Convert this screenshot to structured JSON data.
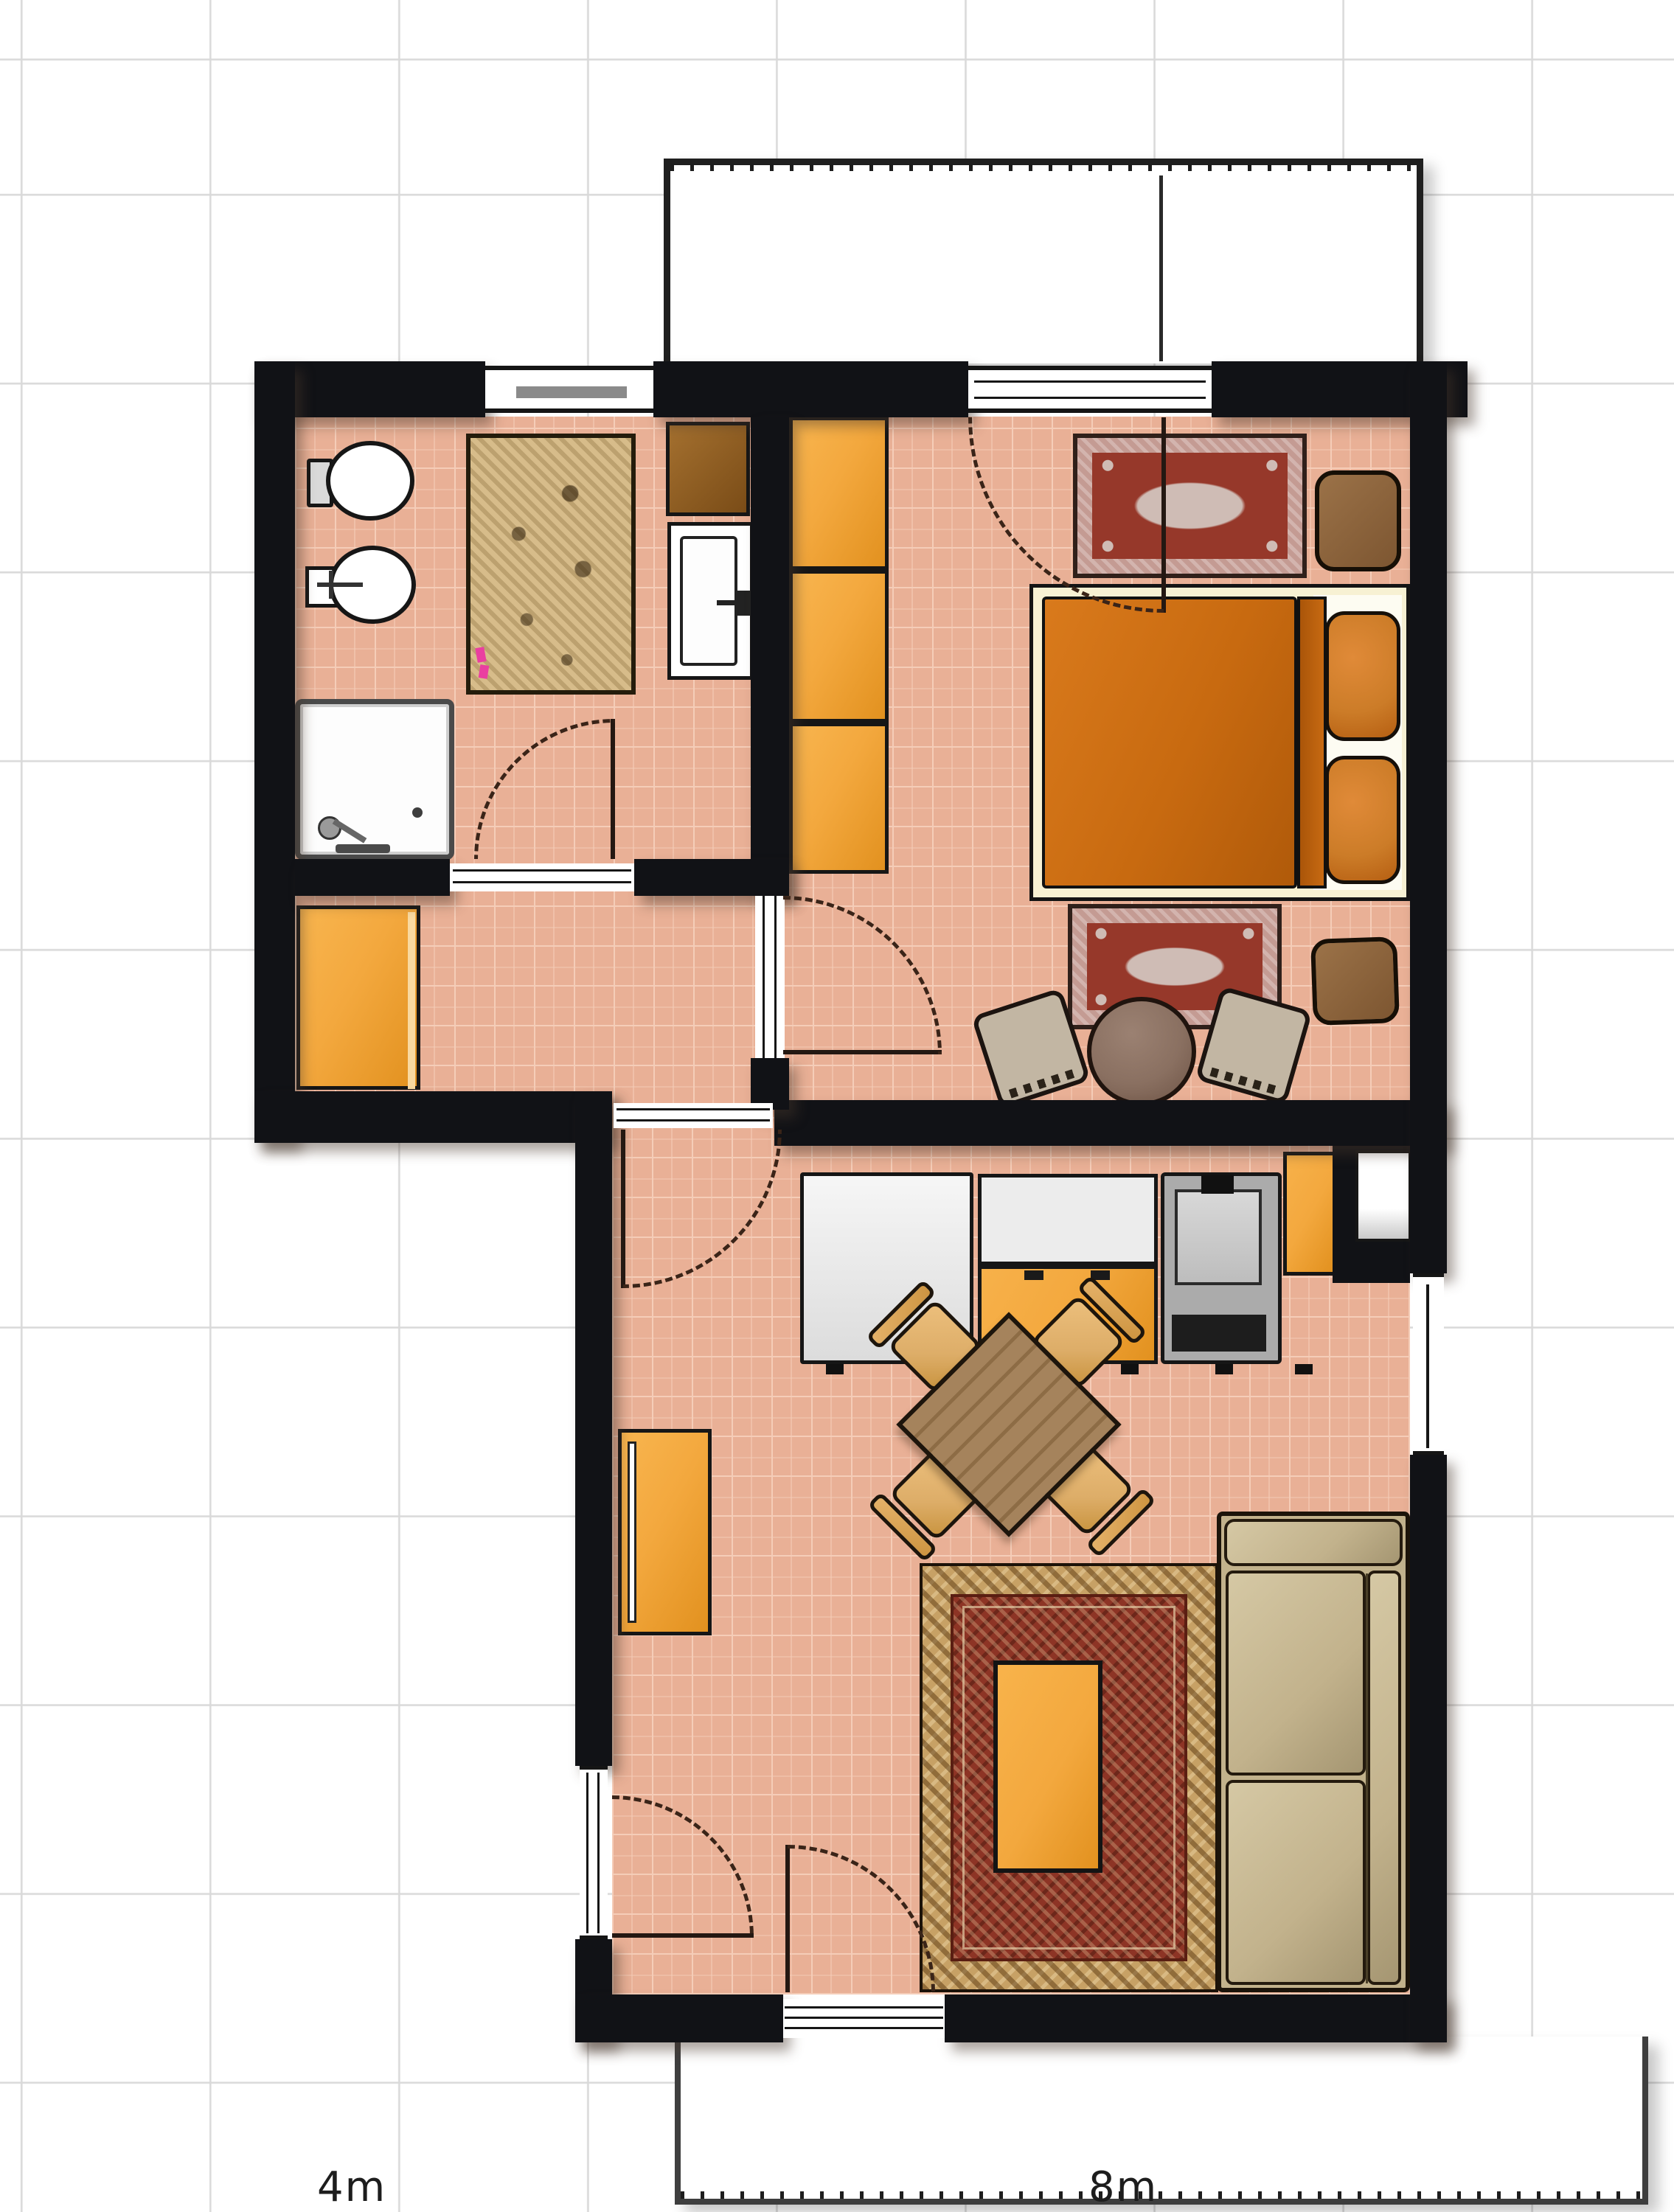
{
  "app": {
    "name": "floor-plan-canvas",
    "view": "2d-top-down",
    "grid_square_meters": 1
  },
  "ruler": {
    "label_4m": "4m",
    "label_8m": "8m"
  },
  "colors": {
    "wall": "#111216",
    "floor": "#e9b096",
    "grout": "#f5cdb8",
    "grid": "#d9d9d9",
    "fixture": "#ffffff",
    "outline": "#161616",
    "arc": "#3a2418",
    "label": "#1d1d1d",
    "orange": "#f3a83e",
    "orange-dark": "#e2911f",
    "cabinet-brown": "#96621f",
    "bed-frame": "#f7f1d3",
    "duvet": "#c86a10",
    "duvet-dark": "#aa5509",
    "pillow": "#cc7c28",
    "sheet": "#fdfcf2",
    "small-rug-border": "#c49b93",
    "small-rug-field": "#96382a",
    "small-rug-medallion": "#cfbcb5",
    "bath-rug": "#d7bc8a",
    "stool": "#8d6740",
    "sofa": "#c2b28c",
    "sofa-light": "#d5c8a4",
    "big-rug-border": "#c7a165",
    "big-rug-field": "#8d3425",
    "table-wood": "#9a7852",
    "chair-wood": "#ddad68",
    "chair-beige": "#c2b6a3",
    "round-table": "#8a7061",
    "counter": "#ececec",
    "stove": "#ababab"
  },
  "rooms": [
    {
      "name": "bathroom",
      "furniture": [
        "toilet",
        "bidet",
        "shower",
        "washbasin",
        "brown-cabinet",
        "bath-rug",
        "slippers"
      ]
    },
    {
      "name": "hallway",
      "furniture": [
        "sideboard"
      ]
    },
    {
      "name": "bedroom",
      "furniture": [
        "wardrobe-3-sections",
        "double-bed",
        "pillows",
        "rug-above-bed",
        "rug-below-bed",
        "stool-top",
        "stool-bottom",
        "round-table",
        "armchair-left",
        "armchair-right"
      ]
    },
    {
      "name": "kitchen-living-room",
      "furniture": [
        "fridge-unit",
        "counter-with-drawers",
        "stove",
        "counter-end-unit",
        "wall-niche",
        "dining-table",
        "dining-chairs-x4",
        "bookshelf",
        "persian-rug",
        "coffee-table",
        "sofa"
      ]
    },
    {
      "name": "balcony-top",
      "furniture": []
    },
    {
      "name": "balcony-bottom",
      "furniture": []
    }
  ],
  "openings": [
    "bathroom-window",
    "bedroom-balcony-door",
    "bathroom-door",
    "hallway-bedroom-door",
    "hallway-livingroom-door",
    "livingroom-left-glass-door",
    "livingroom-right-window",
    "livingroom-balcony-door",
    "kitchen-side-window"
  ]
}
